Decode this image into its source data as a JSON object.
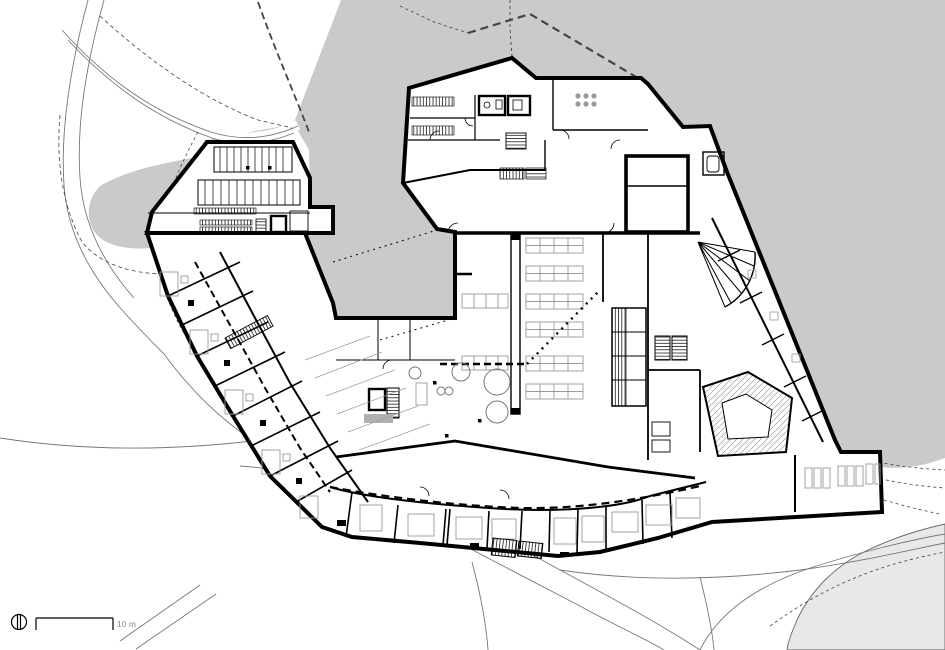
{
  "scale_bar": {
    "label": "10 m"
  },
  "colors": {
    "background": "#ffffff",
    "water": "#cacaca",
    "terrain": "#e8e8e8",
    "walls": "#000000",
    "furniture": "#9a9a9a",
    "paths": "#777777",
    "boundaries": "#444444",
    "scale_text": "#8a8a8a"
  },
  "icons": {
    "north_indicator": "north-indicator-icon"
  }
}
